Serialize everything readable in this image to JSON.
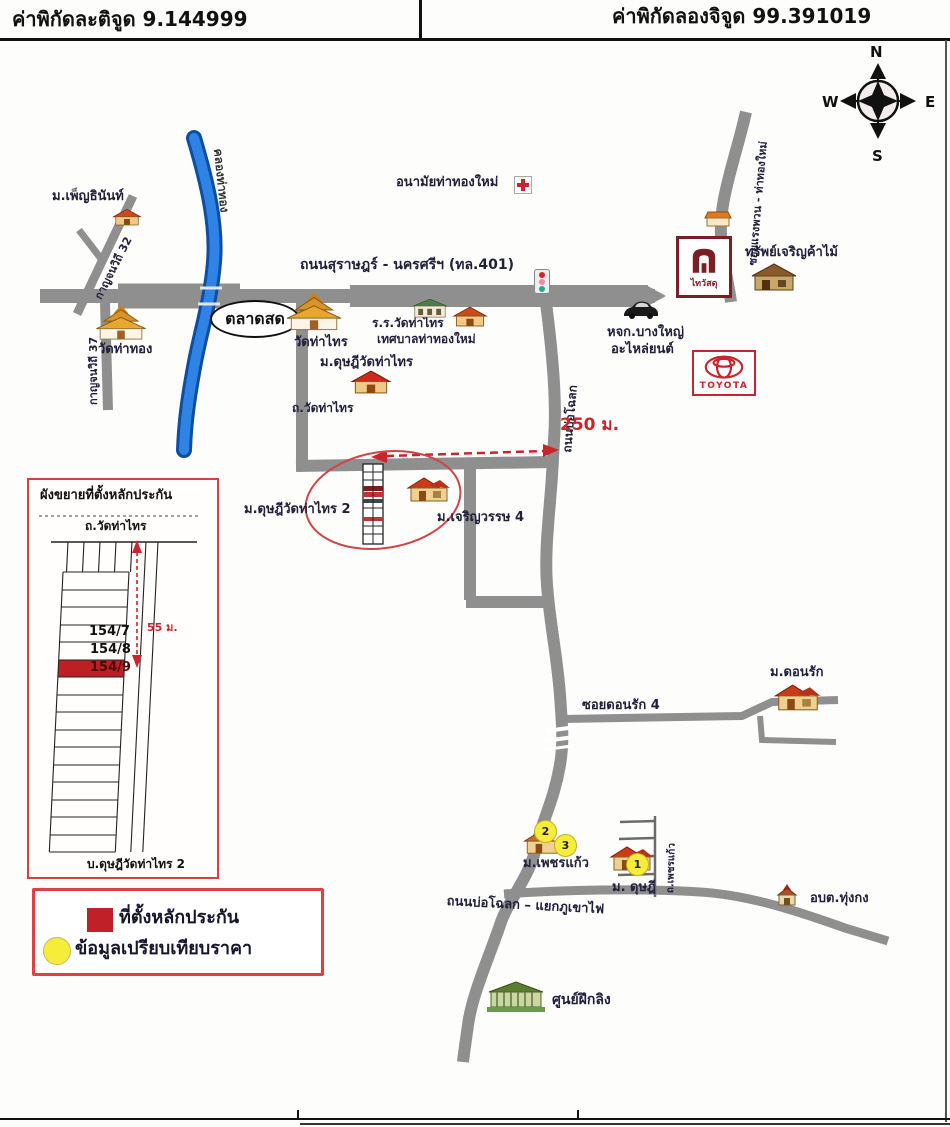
{
  "header": {
    "latitude": "ค่าพิกัดละติจูด 9.144999",
    "longitude": "ค่าพิกัดลองจิจูด 99.391019"
  },
  "compass": {
    "n": "N",
    "e": "E",
    "s": "S",
    "w": "W"
  },
  "roads": {
    "highway401": "ถนนสุราษฎร์ - นครศรีฯ (ทล.401)",
    "canal": "คลองท่าทอง",
    "kanchanawithi32": "กาญจนวิถี 32",
    "kanchanawithi37": "กาญจนวิถี 37",
    "soi_top_right": "ซอยแรงพวน - ท่าทองใหม่",
    "wat_tha_sai_road": "ถ.วัดท่าไทร",
    "bo_chalok": "ถนนบ่อโฉลก",
    "soi_donrak": "ซอยดอนรัก 4",
    "phetkaew_road": "ถ.เพชรแก้ว",
    "bo_chalok_junction": "ถนนบ่อโฉลก – แยกภูเขาไฟ"
  },
  "places": {
    "phenthinan": "ม.เพ็ญธินันท์",
    "wat_tha_thong": "วัดท่าทอง",
    "market": "ตลาดสด",
    "wat_tha_sai": "วัดท่าไทร",
    "school_line1": "ร.ร.วัดท่าไทร",
    "school_line2": "เทศบาลท่าทองใหม่",
    "anamai": "อนามัยท่าทองใหม่",
    "dusadee_wat_tha_sai": "ม.ดุษฎีวัดท่าไทร",
    "thaiwatsadu": "ไทวัสดุ",
    "sap_charoen": "ทรัพย์เจริญค้าไม้",
    "toyota": "TOYOTA",
    "bangyai_line1": "หจก.บางใหญ่",
    "bangyai_line2": "อะไหล่ยนต์",
    "dusadee2": "ม.ดุษฎีวัดท่าไทร 2",
    "charoenwat": "ม.เจริญวรรษ 4",
    "donrak": "ม.ดอนรัก",
    "phetkaew": "ม.เพชรแก้ว",
    "dusadee_main": "ม. ดุษฎี",
    "obt": "อบต.ทุ่งกง",
    "monkey_center": "ศูนย์ฝึกลิง"
  },
  "measure": {
    "d250": "250 ม.",
    "d55": "55 ม."
  },
  "inset": {
    "title": "ผังขยายที่ตั้งหลักประกัน",
    "road_top": "ถ.วัดท่าไทร",
    "plots": [
      "154/7",
      "154/8",
      "154/9"
    ],
    "bottom": "บ.ดุษฎีวัดท่าไทร 2"
  },
  "legend": {
    "collateral": "ที่ตั้งหลักประกัน",
    "comparison": "ข้อมูลเปรียบเทียบราคา"
  },
  "markers": {
    "m1": "1",
    "m2": "2",
    "m3": "3"
  },
  "colors": {
    "road": "#8f8f8f",
    "canal": "#2f83e4",
    "accent_red": "#c8262c",
    "marker_yellow": "#f6ec3a"
  }
}
